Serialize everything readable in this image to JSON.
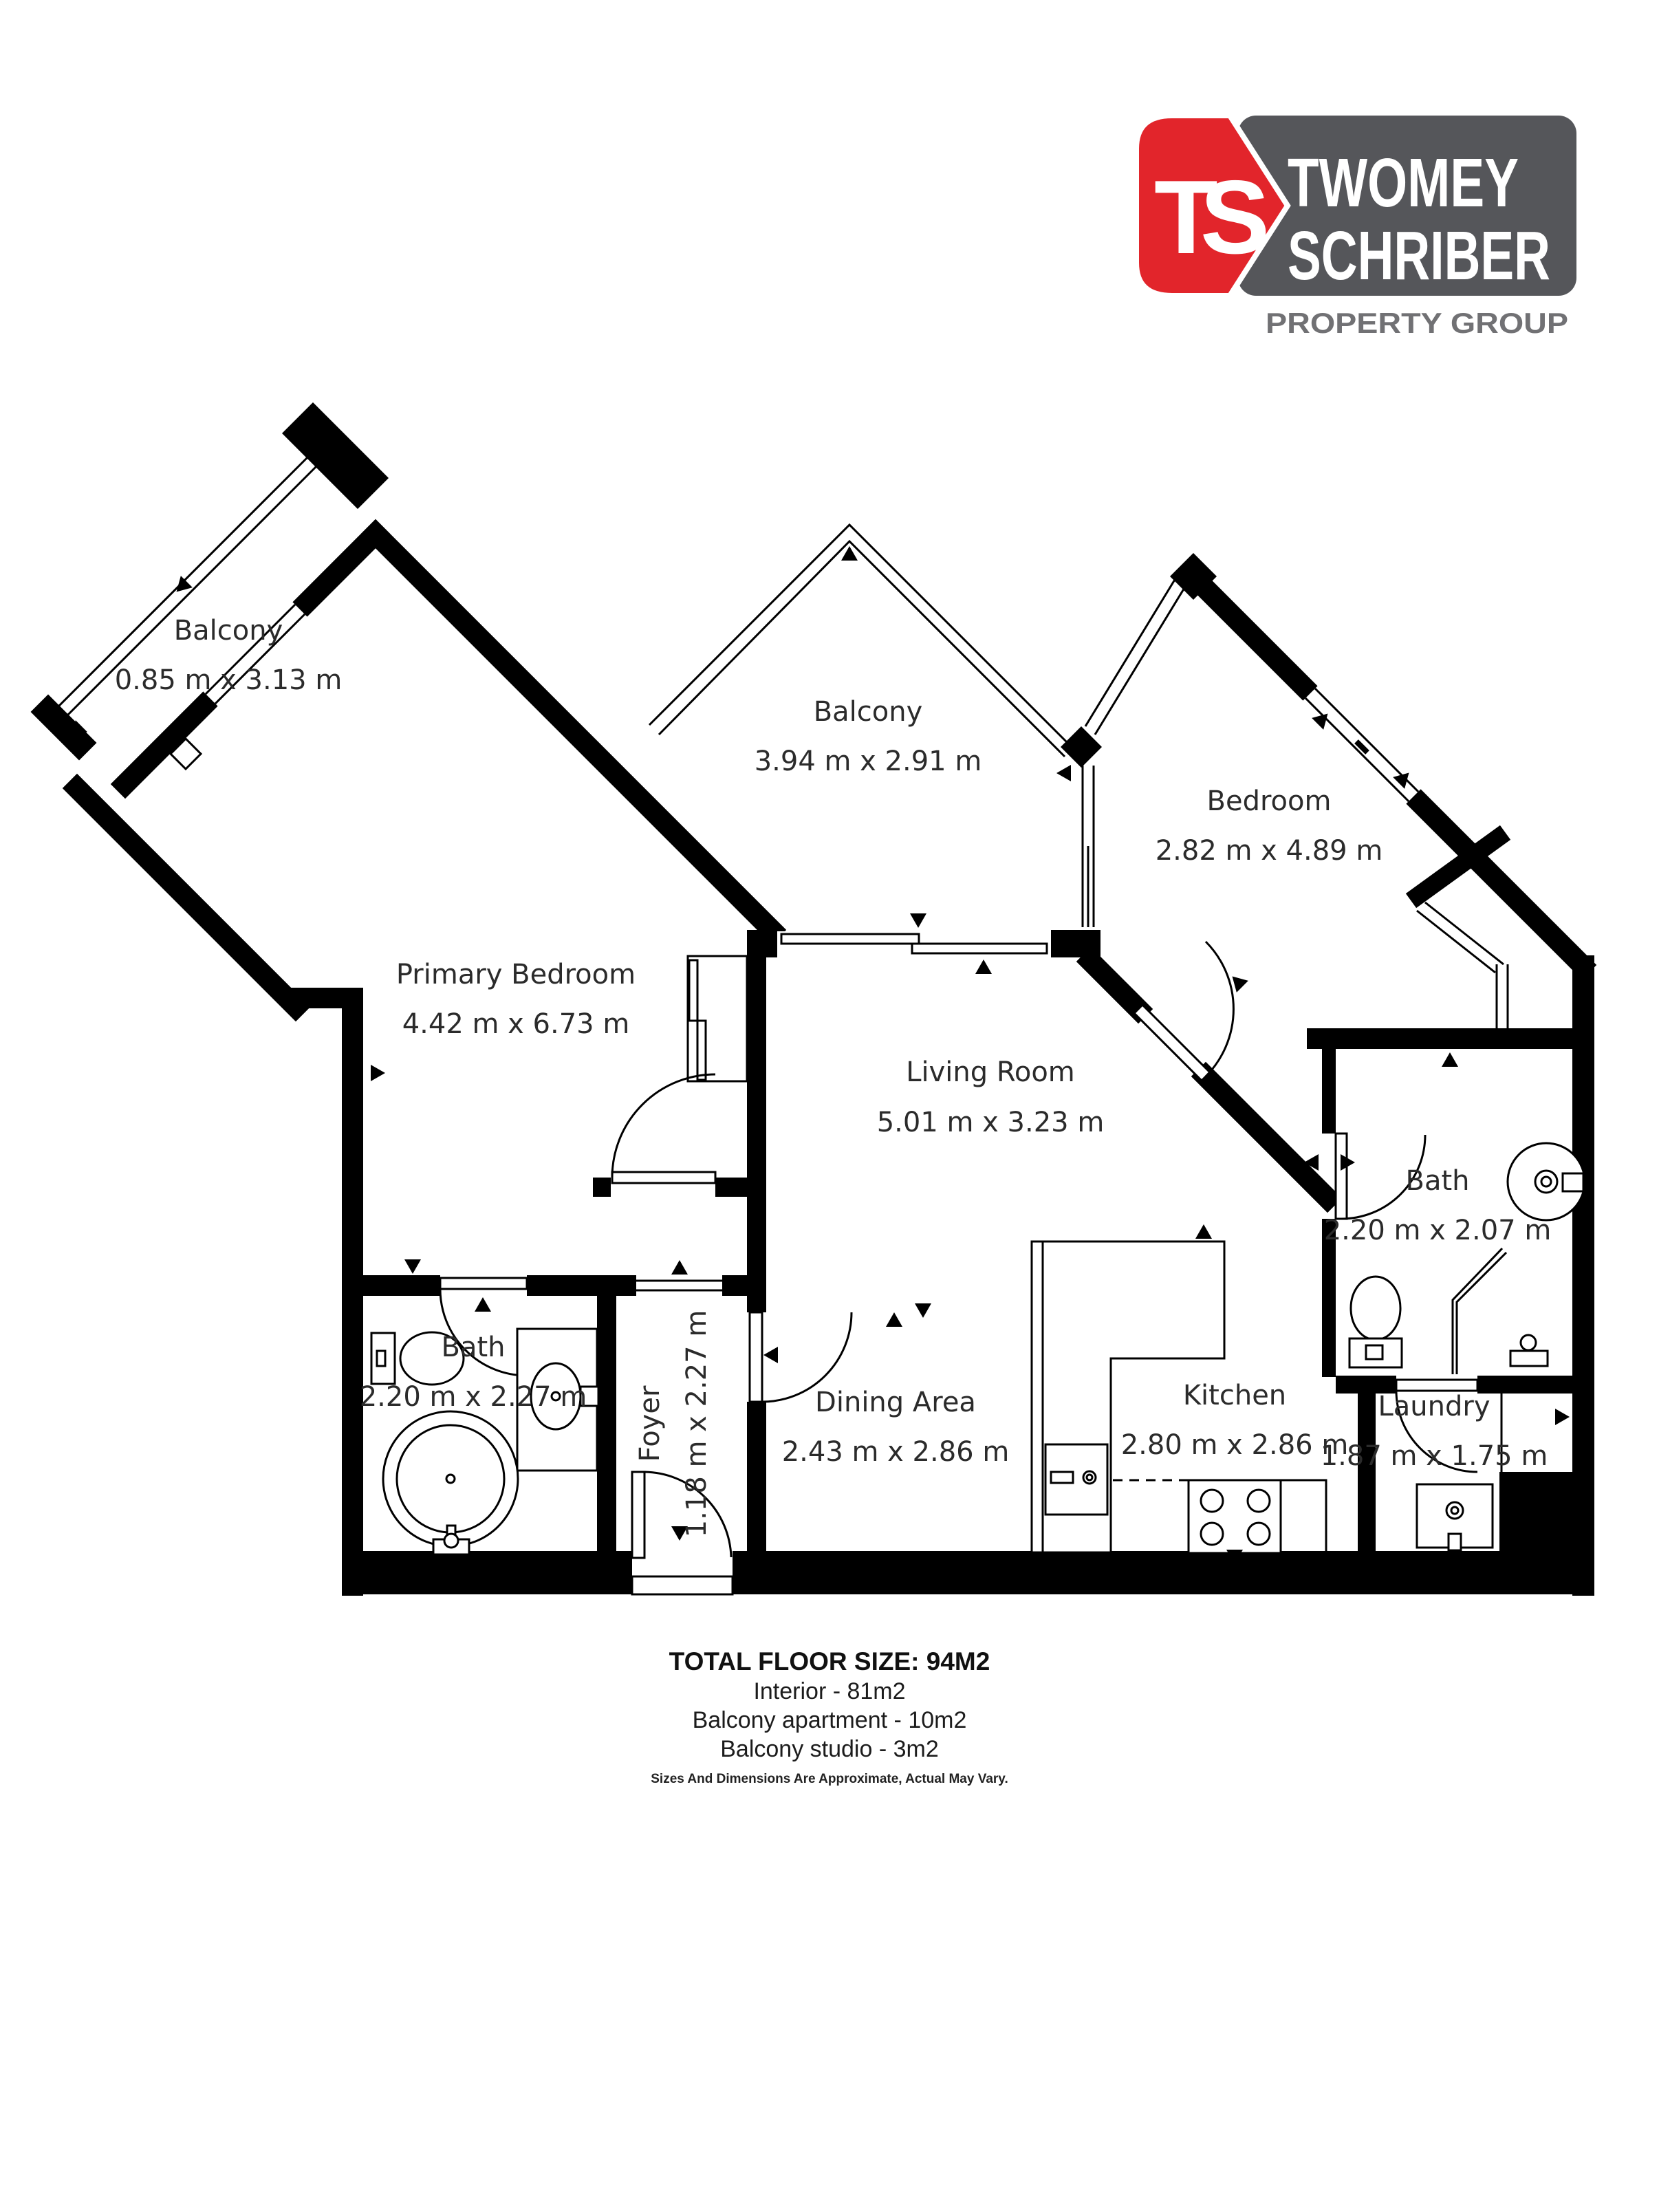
{
  "page": {
    "background": "#ffffff"
  },
  "logo": {
    "monogram": "TS",
    "name_line1": "TWOMEY",
    "name_line2": "SCHRIBER",
    "tagline": "PROPERTY GROUP",
    "red": "#e2252b",
    "dark": "#55565a",
    "tagline_color": "#717174",
    "text_color": "#ffffff"
  },
  "plan": {
    "wall_color": "#000000",
    "label_color": "#2b2b2b",
    "rooms": [
      {
        "id": "balcony-studio",
        "name": "Balcony",
        "dims": "0.85 m x 3.13 m"
      },
      {
        "id": "primary-bedroom",
        "name": "Primary Bedroom",
        "dims": "4.42 m x 6.73 m"
      },
      {
        "id": "balcony-apartment",
        "name": "Balcony",
        "dims": "3.94 m x 2.91 m"
      },
      {
        "id": "bedroom",
        "name": "Bedroom",
        "dims": "2.82 m x 4.89 m"
      },
      {
        "id": "living-room",
        "name": "Living Room",
        "dims": "5.01 m x 3.23 m"
      },
      {
        "id": "bath-left",
        "name": "Bath",
        "dims": "2.20 m x 2.27 m"
      },
      {
        "id": "foyer",
        "name": "Foyer",
        "dims": "1.18 m x 2.27 m"
      },
      {
        "id": "dining-area",
        "name": "Dining Area",
        "dims": "2.43 m x 2.86 m"
      },
      {
        "id": "kitchen",
        "name": "Kitchen",
        "dims": "2.80 m x 2.86 m"
      },
      {
        "id": "bath-right",
        "name": "Bath",
        "dims": "2.20 m x 2.07 m"
      },
      {
        "id": "laundry",
        "name": "Laundry",
        "dims": "1.87 m x 1.75 m"
      }
    ]
  },
  "summary": {
    "title": "TOTAL FLOOR SIZE: 94M2",
    "line1": "Interior - 81m2",
    "line2": "Balcony apartment - 10m2",
    "line3": "Balcony studio - 3m2",
    "footnote": "Sizes And Dimensions Are Approximate, Actual May Vary."
  }
}
